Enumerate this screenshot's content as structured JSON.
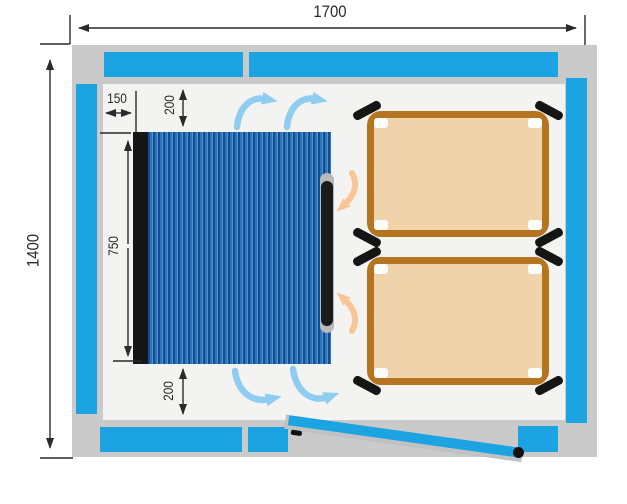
{
  "diagram": {
    "title": "room-heating-floor-plan",
    "dimensions": {
      "room_width": "1700",
      "room_height": "1400",
      "heater_side_offset": "150",
      "heater_top_clearance": "200",
      "heater_length": "750",
      "heater_bottom_clearance": "200"
    },
    "objects": {
      "heater_panels": 1,
      "loungers": 2,
      "doors": 1,
      "cold_airflow_arrows": 4,
      "warm_airflow_arrows": 2
    },
    "colors": {
      "wall": "#cacaca",
      "insulation": "#1ca3e2",
      "floor": "#f3f3f1",
      "heater_dark": "#0f4e95",
      "heater_mid": "#2f74b8",
      "heater_light": "#5291c9",
      "heater_edge": "#161616",
      "handle_cap": "#b9b9b9",
      "bed_fill": "#f0d2ab",
      "bed_frame": "#b5741f",
      "bed_leg": "#151515",
      "cold_air": "#8ecdf0",
      "warm_air": "#f7c694",
      "door": "#1ca3e2",
      "dim": "#2a2a2a"
    }
  }
}
